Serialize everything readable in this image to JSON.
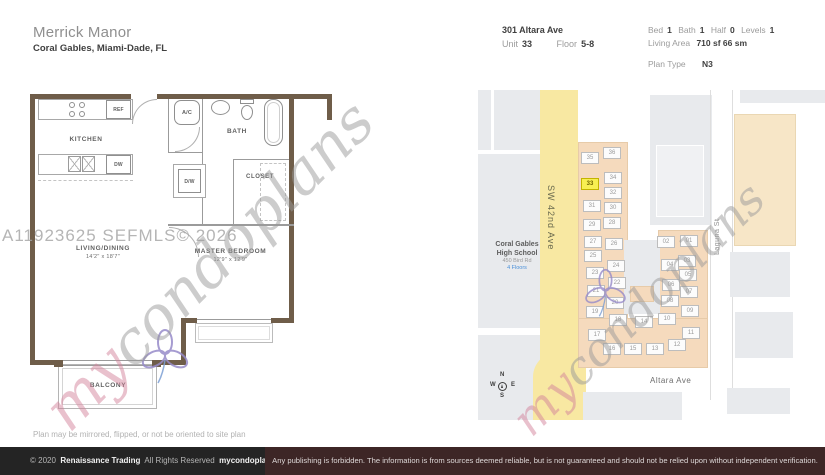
{
  "header": {
    "title": "Merrick Manor",
    "subtitle": "Coral Gables, Miami-Dade, FL",
    "address": "301 Altara Ave",
    "unit_label": "Unit",
    "unit_value": "33",
    "floor_label": "Floor",
    "floor_value": "5-8",
    "stats": [
      {
        "label": "Bed",
        "value": "1"
      },
      {
        "label": "Bath",
        "value": "1"
      },
      {
        "label": "Half",
        "value": "0"
      },
      {
        "label": "Levels",
        "value": "1"
      }
    ],
    "living_area_label": "Living Area",
    "living_area_value": "710 sf 66 sm",
    "plan_type_label": "Plan Type",
    "plan_type_value": "N3"
  },
  "floorplan": {
    "labels": {
      "kitchen": "KITCHEN",
      "bath": "BATH",
      "closet": "CLOSET",
      "balcony": "BALCONY",
      "ref": "REF",
      "dw": "DW",
      "ac": "A/C",
      "wd": "D/W",
      "living": "LIVING/DINING",
      "living_dims": "14'2\" x 18'7\"",
      "master": "MASTER BEDROOM",
      "master_dims": "12'9\" x 12'9\""
    },
    "note": "Plan may be mirrored, flipped, or not be oriented to site plan"
  },
  "watermarks": {
    "mls": "A11923625  SEFMLS© 2026",
    "brand_prefix": "my",
    "brand_suffix": "condoplans"
  },
  "siteplan": {
    "street_vertical": "SW 42nd Ave",
    "street_horizontal": "Altara Ave",
    "street_east": "Laguna St",
    "school": {
      "line1": "Coral Gables",
      "line2": "High School",
      "line3": "450 Bird Rd",
      "line4": "4 Floors"
    },
    "compass": {
      "n": "N",
      "w": "W",
      "e": "E",
      "s": "S"
    },
    "highlight_unit": "33",
    "units": [
      {
        "n": "01",
        "x": 211,
        "y": 151
      },
      {
        "n": "02",
        "x": 188,
        "y": 152
      },
      {
        "n": "03",
        "x": 209,
        "y": 171
      },
      {
        "n": "04",
        "x": 192,
        "y": 175
      },
      {
        "n": "05",
        "x": 210,
        "y": 185
      },
      {
        "n": "06",
        "x": 193,
        "y": 195
      },
      {
        "n": "07",
        "x": 211,
        "y": 202
      },
      {
        "n": "08",
        "x": 192,
        "y": 211
      },
      {
        "n": "09",
        "x": 212,
        "y": 221
      },
      {
        "n": "10",
        "x": 189,
        "y": 229
      },
      {
        "n": "11",
        "x": 213,
        "y": 243
      },
      {
        "n": "12",
        "x": 199,
        "y": 255
      },
      {
        "n": "13",
        "x": 177,
        "y": 259
      },
      {
        "n": "14",
        "x": 166,
        "y": 232
      },
      {
        "n": "15",
        "x": 155,
        "y": 259
      },
      {
        "n": "16",
        "x": 134,
        "y": 259
      },
      {
        "n": "17",
        "x": 119,
        "y": 245
      },
      {
        "n": "18",
        "x": 140,
        "y": 230
      },
      {
        "n": "19",
        "x": 117,
        "y": 222
      },
      {
        "n": "20",
        "x": 137,
        "y": 213
      },
      {
        "n": "21",
        "x": 118,
        "y": 201
      },
      {
        "n": "22",
        "x": 139,
        "y": 193
      },
      {
        "n": "23",
        "x": 117,
        "y": 183
      },
      {
        "n": "24",
        "x": 138,
        "y": 176
      },
      {
        "n": "25",
        "x": 115,
        "y": 166
      },
      {
        "n": "26",
        "x": 136,
        "y": 154
      },
      {
        "n": "27",
        "x": 115,
        "y": 152
      },
      {
        "n": "28",
        "x": 134,
        "y": 133
      },
      {
        "n": "29",
        "x": 114,
        "y": 135
      },
      {
        "n": "30",
        "x": 135,
        "y": 118
      },
      {
        "n": "31",
        "x": 114,
        "y": 116
      },
      {
        "n": "32",
        "x": 135,
        "y": 103
      },
      {
        "n": "33",
        "x": 112,
        "y": 94
      },
      {
        "n": "34",
        "x": 135,
        "y": 88
      },
      {
        "n": "35",
        "x": 112,
        "y": 68
      },
      {
        "n": "36",
        "x": 134,
        "y": 63
      }
    ]
  },
  "footer": {
    "copyright": "© 2020",
    "company": "Renaissance Trading",
    "rights": "All Rights Reserved",
    "brand": "mycondoplans®",
    "disclaimer": "Any publishing is forbidden.  The information is from sources deemed reliable, but is not guaranteed and should not be relied upon without independent verification."
  }
}
